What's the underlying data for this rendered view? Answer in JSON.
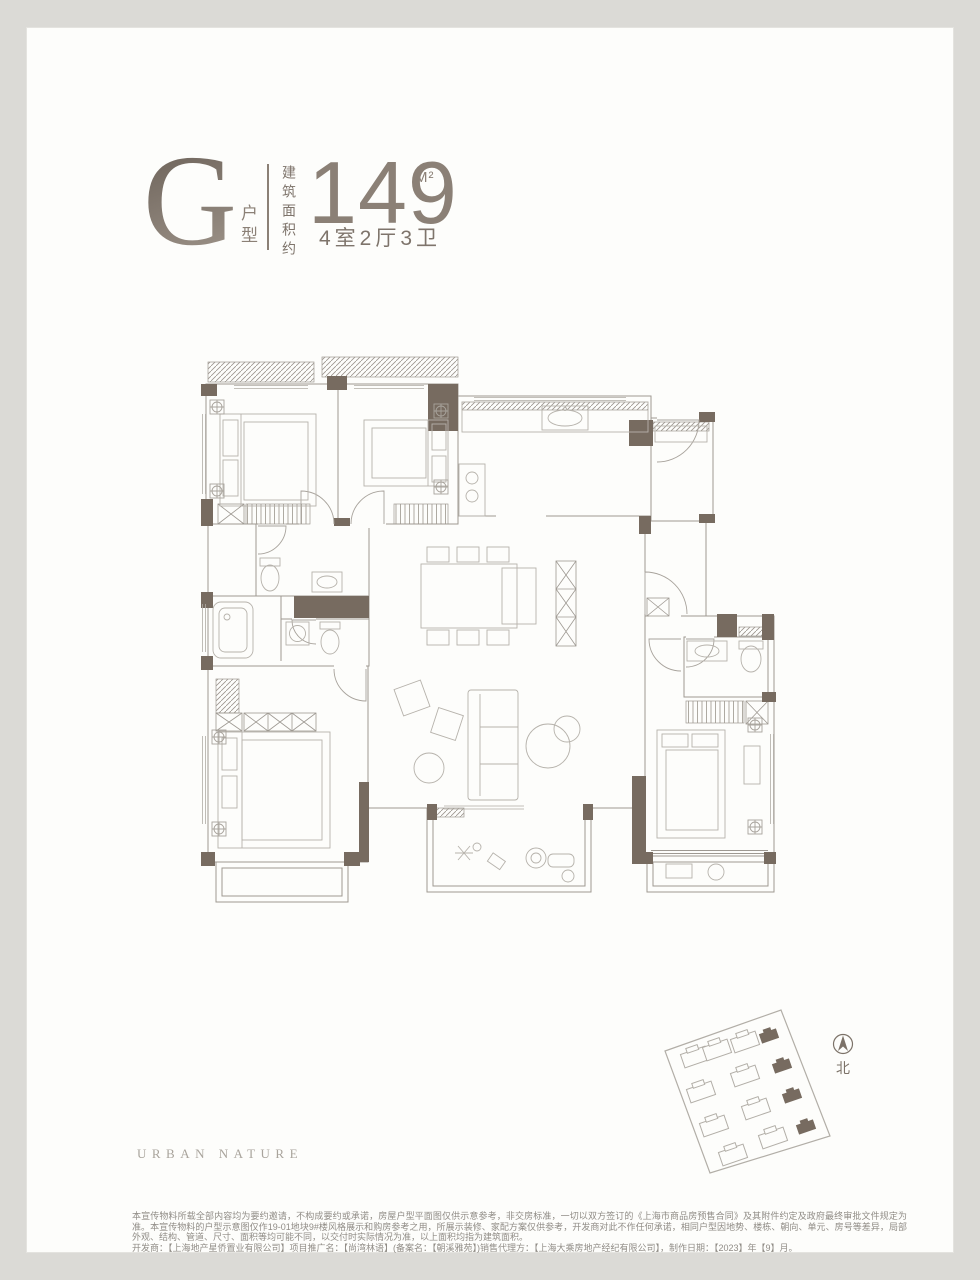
{
  "header": {
    "unit_letter": "G",
    "unit_suffix": "户型",
    "area_label": "建筑面积约",
    "area_value": "149",
    "area_unit": "M²",
    "rooms_text": "4室2厅3卫"
  },
  "sitemap": {
    "north_label": "北"
  },
  "footer": {
    "brand": "URBAN NATURE"
  },
  "disclaimer": {
    "para1": "本宣传物料所载全部内容均为要约邀请，不构成要约或承诺，房屋户型平面图仅供示意参考，非交房标准，一切以双方签订的《上海市商品房预售合同》及其附件约定及政府最终审批文件规定为准。本宣传物料的户型示意图仅作19-01地块9#楼风格展示和购房参考之用，所展示装修、家配方案仅供参考，开发商对此不作任何承诺，相同户型因地势、楼栋、朝向、单元、房号等差异，局部外观、结构、管道、尺寸、面积等均可能不同，以交付时实际情况为准，以上面积均指为建筑面积。",
    "para2": "开发商：【上海地产星侨置业有限公司】项目推广名：【尚湾林语】(备案名：【朝溪雅苑】)销售代理方：【上海大乘房地产经纪有限公司】，制作日期：【2023】年【9】月。"
  },
  "colors": {
    "accent": "#8b8076",
    "wall": "#776b60",
    "page_bg": "#dbdad6",
    "card_bg": "#fdfdfb"
  }
}
